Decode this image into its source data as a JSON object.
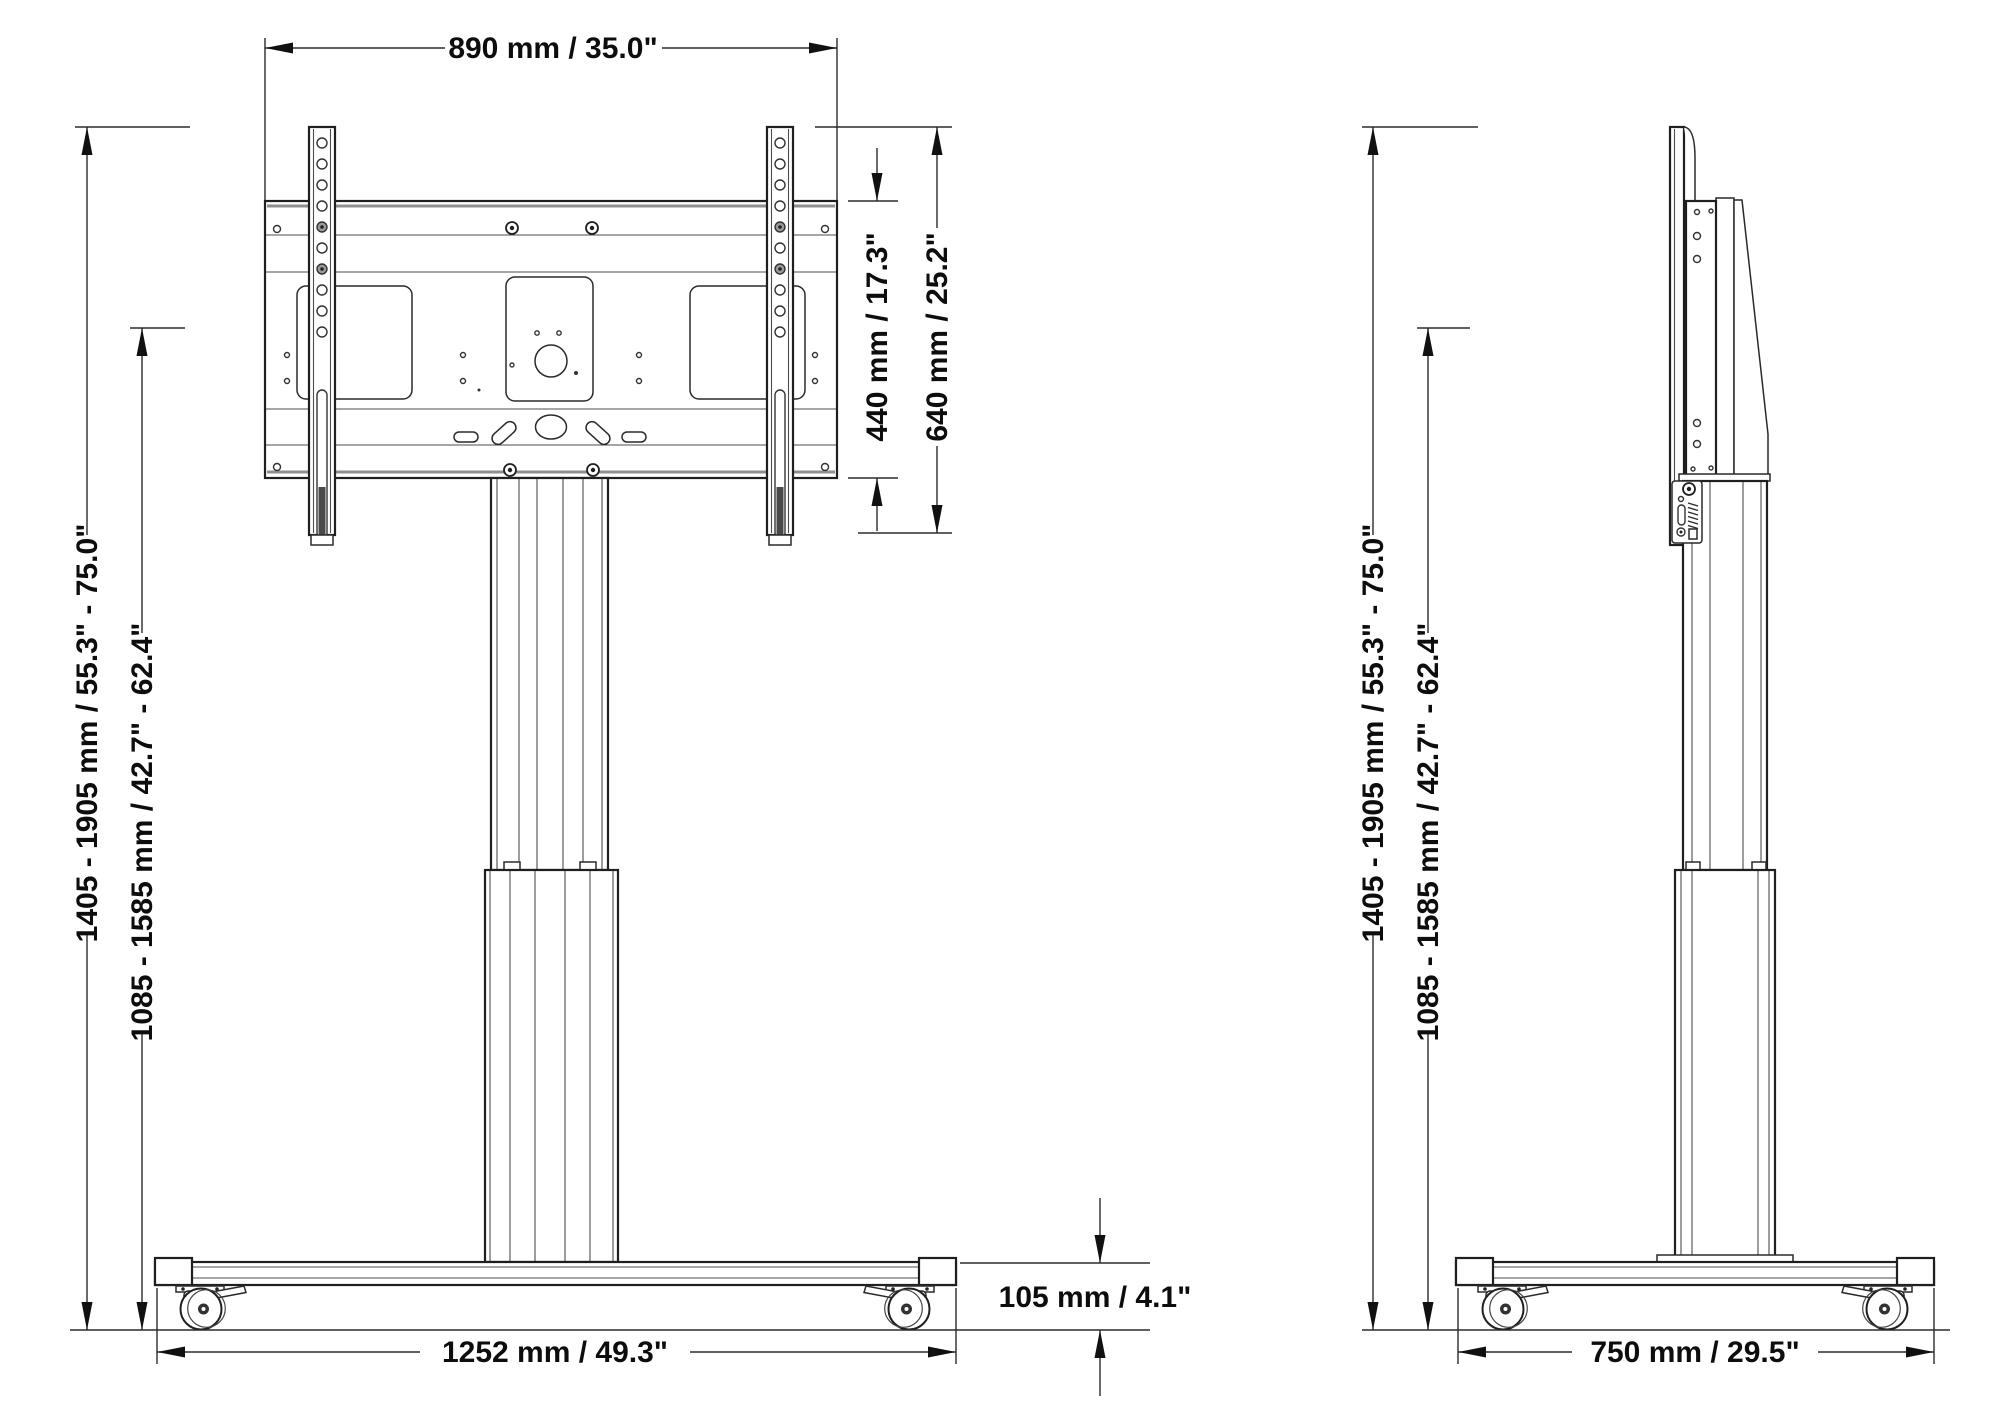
{
  "dimensions": {
    "mount_width": "890 mm / 35.0\"",
    "plate_height": "440 mm / 17.3\"",
    "bracket_height": "640 mm / 25.2\"",
    "overall_height_range": "1405 - 1905 mm / 55.3\" - 75.0\"",
    "center_height_range": "1085 - 1585 mm / 42.7\" - 62.4\"",
    "base_height": "105 mm /  4.1\"",
    "base_width": "1252 mm / 49.3\"",
    "base_depth": "750 mm / 29.5\""
  }
}
